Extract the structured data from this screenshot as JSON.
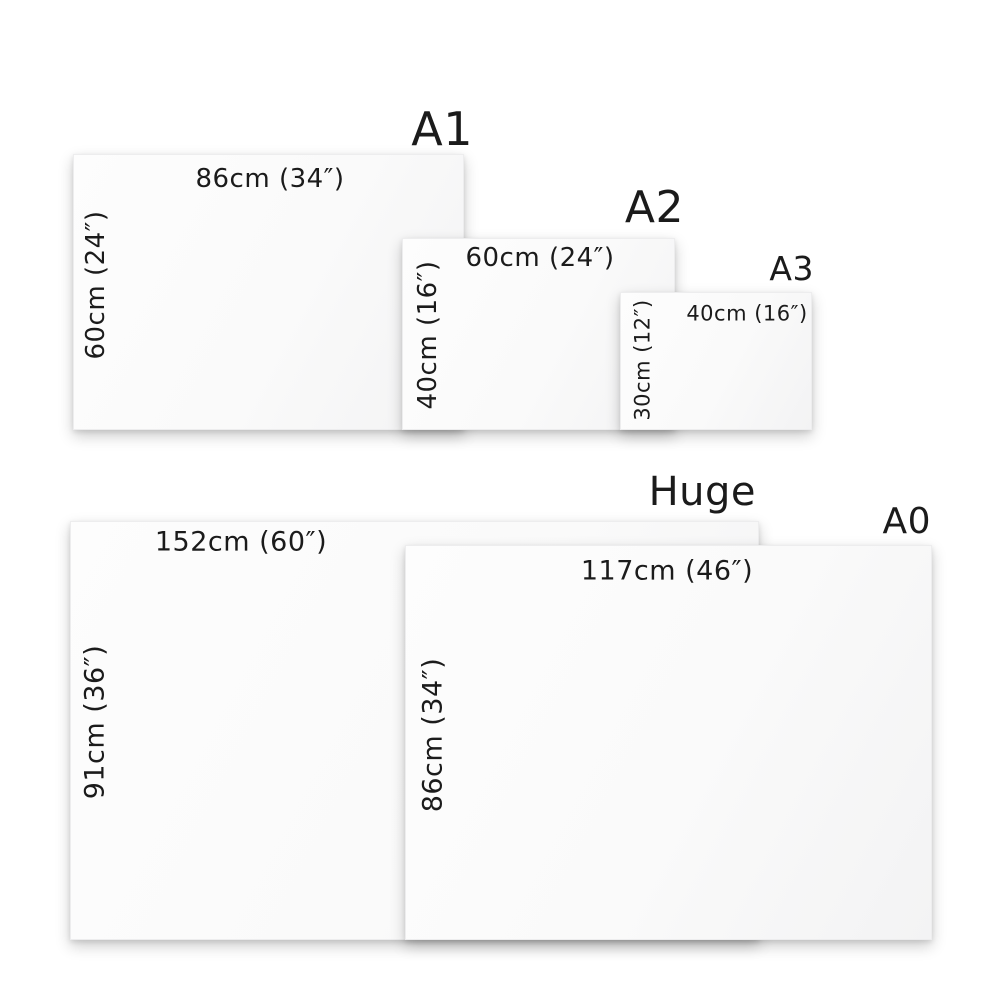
{
  "diagram": {
    "description": "Canvas print size comparison chart",
    "background": "#ffffff",
    "text_color": "#1b1b1b",
    "canvas_fill": "#fafafa"
  },
  "sizes": [
    {
      "name": "A1",
      "width_label": "86cm (34″)",
      "height_label": "60cm (24″)"
    },
    {
      "name": "A2",
      "width_label": "60cm (24″)",
      "height_label": "40cm (16″)"
    },
    {
      "name": "A3",
      "width_label": "40cm (16″)",
      "height_label": "30cm (12″)"
    },
    {
      "name": "Huge",
      "width_label": "152cm (60″)",
      "height_label": "91cm (36″)"
    },
    {
      "name": "A0",
      "width_label": "117cm (46″)",
      "height_label": "86cm (34″)"
    }
  ]
}
